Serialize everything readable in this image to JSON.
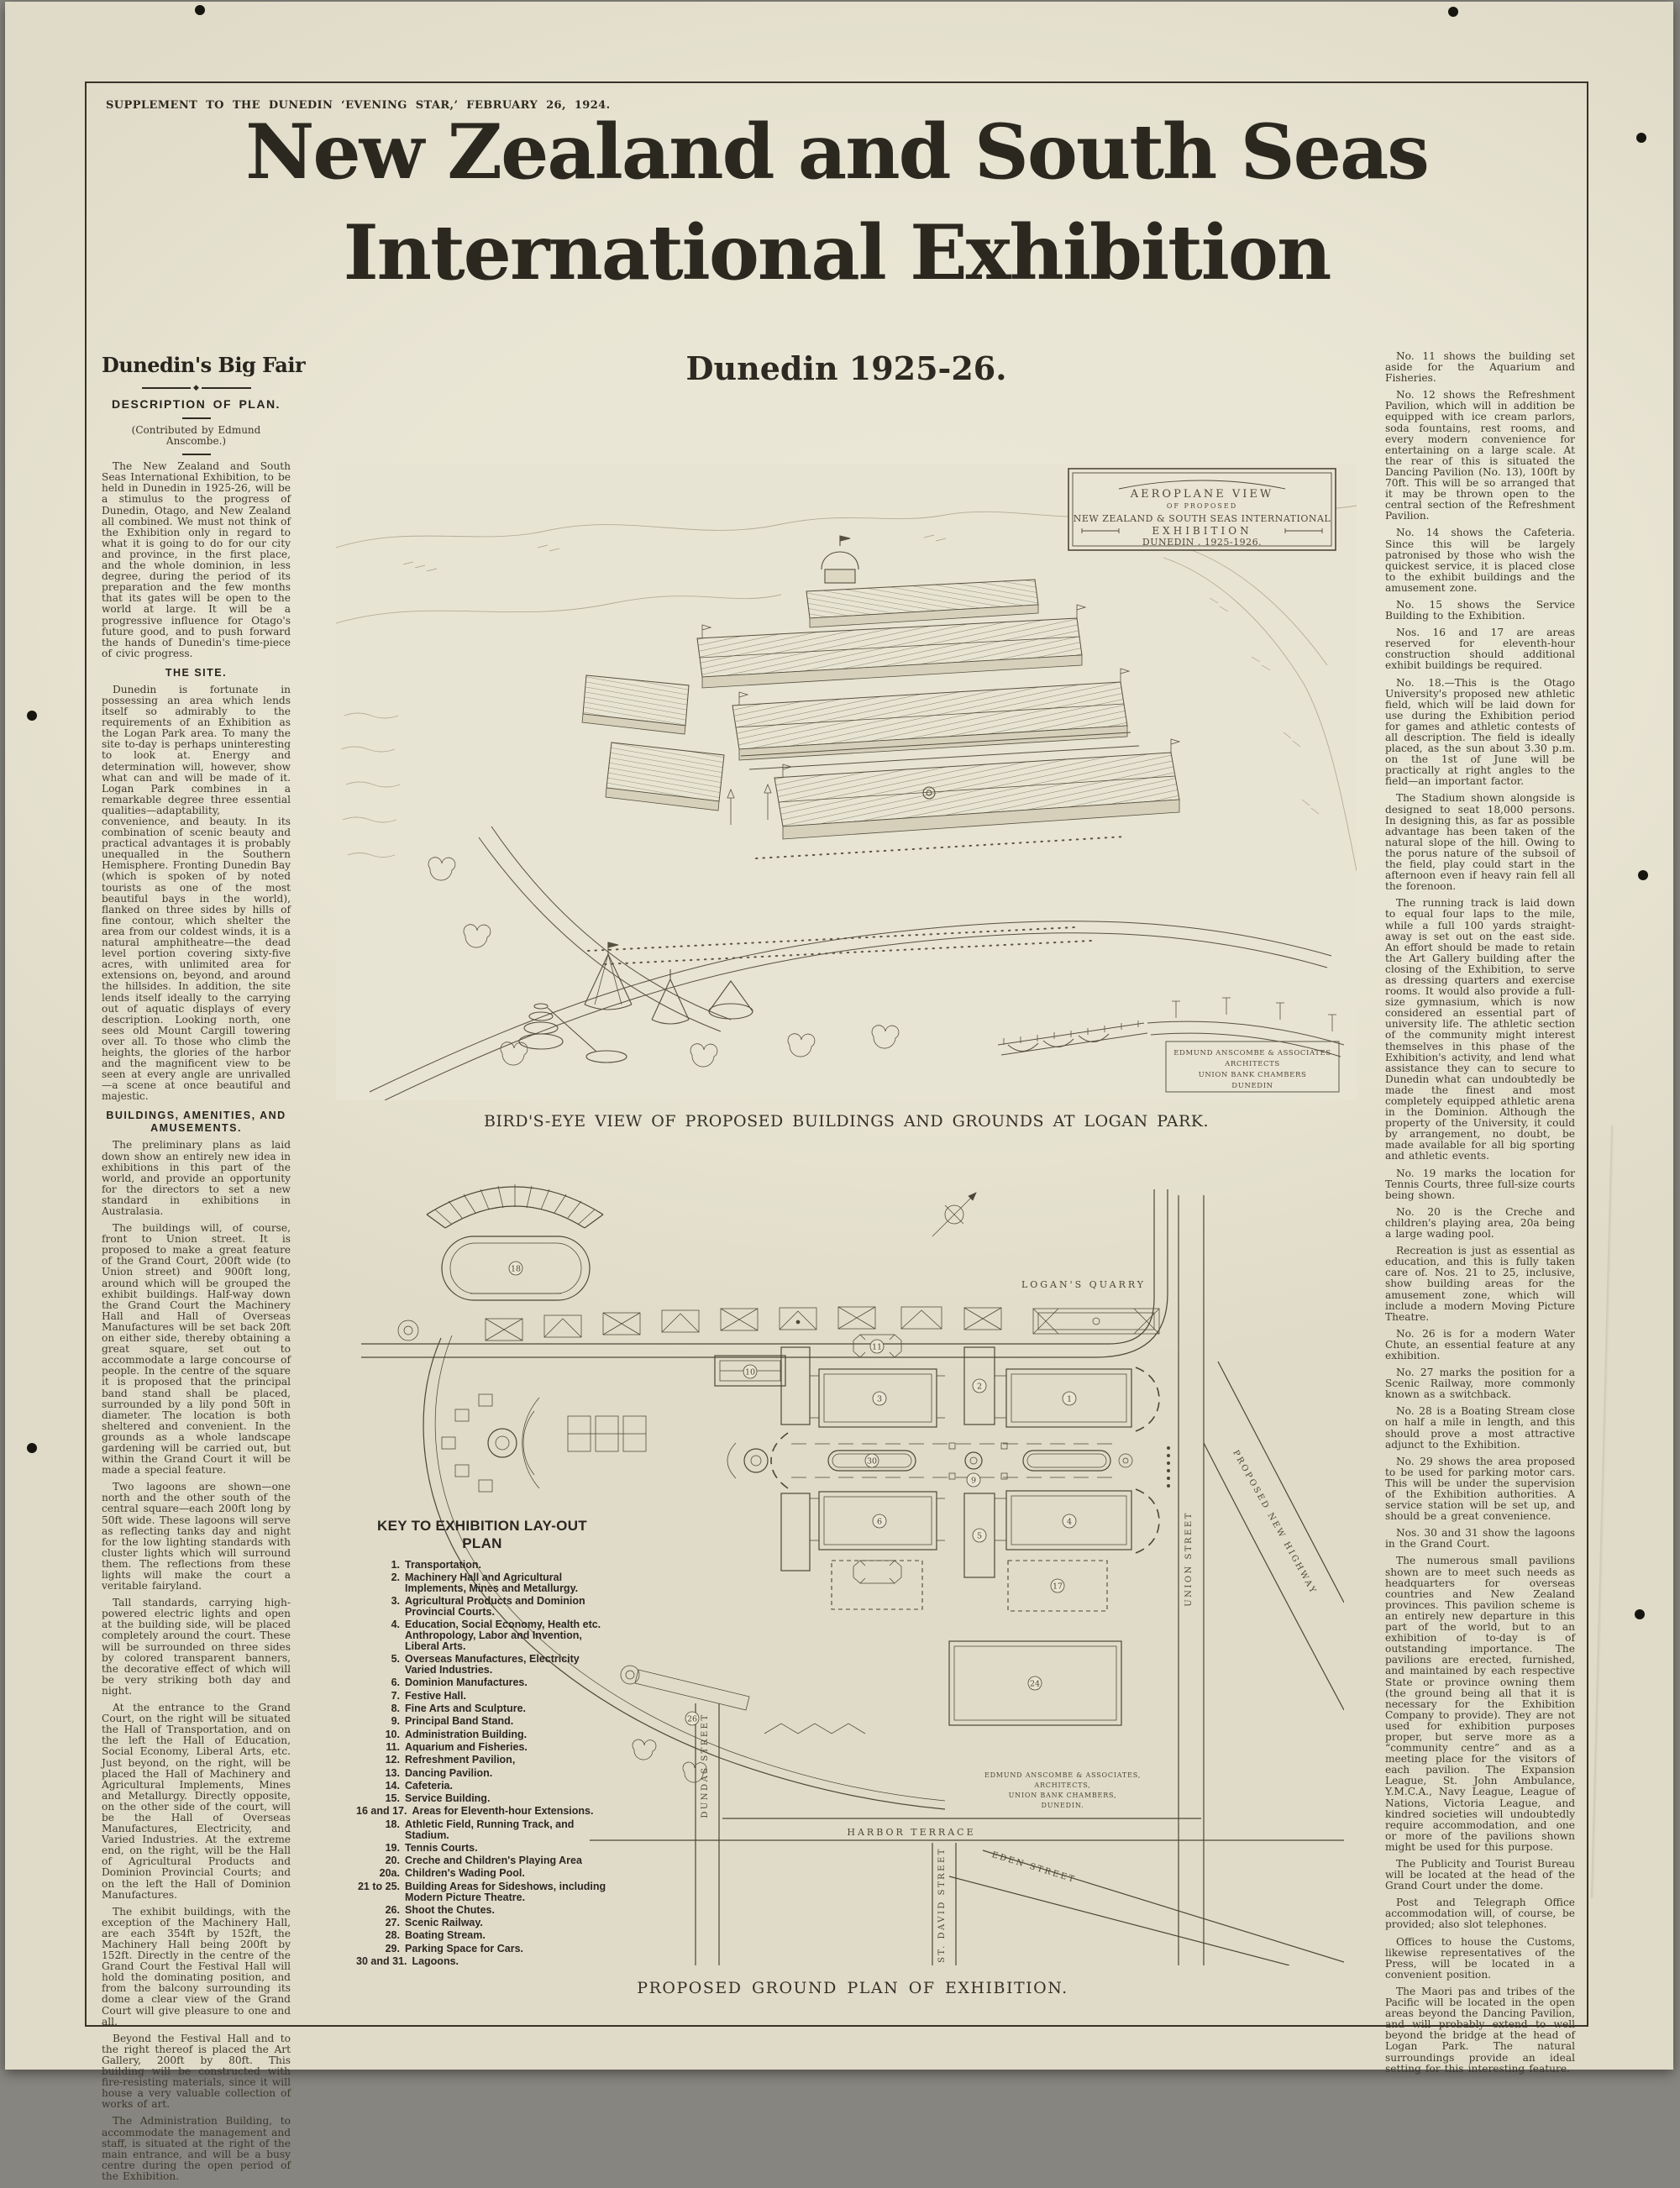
{
  "colors": {
    "paper": "#e9e5d4",
    "ink": "#2d2a22",
    "backdrop": "#87857f"
  },
  "masthead": {
    "supplement_line": "SUPPLEMENT TO THE DUNEDIN ‘EVENING STAR,’ FEBRUARY 26, 1924.",
    "title_line1": "New Zealand and South Seas",
    "title_line2": "International Exhibition",
    "subtitle": "Dunedin 1925-26."
  },
  "left_column": {
    "headline": "Dunedin's Big Fair",
    "subhead": "DESCRIPTION OF PLAN.",
    "byline": "(Contributed by Edmund Anscombe.)",
    "sections": {
      "intro": [
        "The New Zealand and South Seas International Exhibition, to be held in Dunedin in 1925-26, will be a stimulus to the progress of Dunedin, Otago, and New Zealand all combined. We must not think of the Exhibition only in regard to what it is going to do for our city and province, in the first place, and the whole dominion, in less degree, during the period of its preparation and the few months that its gates will be open to the world at large. It will be a progressive influence for Otago's future good, and to push forward the hands of Dunedin's time-piece of civic progress."
      ],
      "site_heading": "THE SITE.",
      "site": [
        "Dunedin is fortunate in possessing an area which lends itself so admirably to the requirements of an Exhibition as the Logan Park area. To many the site to-day is perhaps uninteresting to look at. Energy and determination will, however, show what can and will be made of it. Logan Park combines in a remarkable degree three essential qualities—adaptability, convenience, and beauty. In its combination of scenic beauty and practical advantages it is probably unequalled in the Southern Hemisphere. Fronting Dunedin Bay (which is spoken of by noted tourists as one of the most beautiful bays in the world), flanked on three sides by hills of fine contour, which shelter the area from our coldest winds, it is a natural amphitheatre—the dead level portion covering sixty-five acres, with unlimited area for extensions on, beyond, and around the hillsides. In addition, the site lends itself ideally to the carrying out of aquatic displays of every description. Looking north, one sees old Mount Cargill towering over all. To those who climb the heights, the glories of the harbor and the magnificent view to be seen at every angle are unrivalled—a scene at once beautiful and majestic."
      ],
      "amusements_heading": "BUILDINGS, AMENITIES, AND AMUSEMENTS.",
      "amusements": [
        "The preliminary plans as laid down show an entirely new idea in exhibitions in this part of the world, and provide an opportunity for the directors to set a new standard in exhibitions in Australasia.",
        "The buildings will, of course, front to Union street. It is proposed to make a great feature of the Grand Court, 200ft wide (to Union street) and 900ft long, around which will be grouped the exhibit buildings. Half-way down the Grand Court the Machinery Hall and Hall of Overseas Manufactures will be set back 20ft on either side, thereby obtaining a great square, set out to accommodate a large concourse of people. In the centre of the square it is proposed that the principal band stand shall be placed, surrounded by a lily pond 50ft in diameter. The location is both sheltered and convenient. In the grounds as a whole landscape gardening will be carried out, but within the Grand Court it will be made a special feature.",
        "Two lagoons are shown—one north and the other south of the central square—each 200ft long by 50ft wide. These lagoons will serve as reflecting tanks day and night for the low lighting standards with cluster lights which will surround them. The reflections from these lights will make the court a veritable fairyland.",
        "Tall standards, carrying high-powered electric lights and open at the building side, will be placed completely around the court. These will be surrounded on three sides by colored transparent banners, the decorative effect of which will be very striking both day and night.",
        "At the entrance to the Grand Court, on the right will be situated the Hall of Transportation, and on the left the Hall of Education, Social Economy, Liberal Arts, etc. Just beyond, on the right, will be placed the Hall of Machinery and Agricultural Implements, Mines and Metallurgy. Directly opposite, on the other side of the court, will be the Hall of Overseas Manufactures, Electricity, and Varied Industries. At the extreme end, on the right, will be the Hall of Agricultural Products and Dominion Provincial Courts; and on the left the Hall of Dominion Manufactures.",
        "The exhibit buildings, with the exception of the Machinery Hall, are each 354ft by 152ft, the Machinery Hall being 200ft by 152ft. Directly in the centre of the Grand Court the Festival Hall will hold the dominating position, and from the balcony surrounding its dome a clear view of the Grand Court will give pleasure to one and all.",
        "Beyond the Festival Hall and to the right thereof is placed the Art Gallery, 200ft by 80ft. This building will be constructed with fire-resisting materials, since it will house a very valuable collection of works of art.",
        "The Administration Building, to accommodate the management and staff, is situated at the right of the main entrance, and will be a busy centre during the open period of the Exhibition."
      ]
    }
  },
  "right_column": {
    "paragraphs": [
      "No. 11 shows the building set aside for the Aquarium and Fisheries.",
      "No. 12 shows the Refreshment Pavilion, which will in addition be equipped with ice cream parlors, soda fountains, rest rooms, and every modern convenience for entertaining on a large scale. At the rear of this is situated the Dancing Pavilion (No. 13), 100ft by 70ft. This will be so arranged that it may be thrown open to the central section of the Refreshment Pavilion.",
      "No. 14 shows the Cafeteria. Since this will be largely patronised by those who wish the quickest service, it is placed close to the exhibit buildings and the amusement zone.",
      "No. 15 shows the Service Building to the Exhibition.",
      "Nos. 16 and 17 are areas reserved for eleventh-hour construction should additional exhibit buildings be required.",
      "No. 18.—This is the Otago University's proposed new athletic field, which will be laid down for use during the Exhibition period for games and athletic contests of all description. The field is ideally placed, as the sun about 3.30 p.m. on the 1st of June will be practically at right angles to the field—an important factor.",
      "The Stadium shown alongside is designed to seat 18,000 persons. In designing this, as far as possible advantage has been taken of the natural slope of the hill. Owing to the porus nature of the subsoil of the field, play could start in the afternoon even if heavy rain fell all the forenoon.",
      "The running track is laid down to equal four laps to the mile, while a full 100 yards straight-away is set out on the east side. An effort should be made to retain the Art Gallery building after the closing of the Exhibition, to serve as dressing quarters and exercise rooms. It would also provide a full-size gymnasium, which is now considered an essential part of university life. The athletic section of the community might interest themselves in this phase of the Exhibition's activity, and lend what assistance they can to secure to Dunedin what can undoubtedly be made the finest and most completely equipped athletic arena in the Dominion. Although the property of the University, it could by arrangement, no doubt, be made available for all big sporting and athletic events.",
      "No. 19 marks the location for Tennis Courts, three full-size courts being shown.",
      "No. 20 is the Creche and children's playing area, 20a being a large wading pool.",
      "Recreation is just as essential as education, and this is fully taken care of. Nos. 21 to 25, inclusive, show building areas for the amusement zone, which will include a modern Moving Picture Theatre.",
      "No. 26 is for a modern Water Chute, an essential feature at any exhibition.",
      "No. 27 marks the position for a Scenic Railway, more commonly known as a switchback.",
      "No. 28 is a Boating Stream close on half a mile in length, and this should prove a most attractive adjunct to the Exhibition.",
      "No. 29 shows the area proposed to be used for parking motor cars. This will be under the supervision of the Exhibition authorities. A service station will be set up, and should be a great convenience.",
      "Nos. 30 and 31 show the lagoons in the Grand Court.",
      "The numerous small pavilions shown are to meet such needs as headquarters for overseas countries and New Zealand provinces. This pavilion scheme is an entirely new departure in this part of the world, but to an exhibition of to-day is of outstanding importance. The pavilions are erected, furnished, and maintained by each respective State or province owning them (the ground being all that it is necessary for the Exhibition Company to provide). They are not used for exhibition purposes proper, but serve more as a “community centre” and as a meeting place for the visitors of each pavilion. The Expansion League, St. John Ambulance, Y.M.C.A., Navy League, League of Nations, Victoria League, and kindred societies will undoubtedly require accommodation, and one or more of the pavilions shown might be used for this purpose.",
      "The Publicity and Tourist Bureau will be located at the head of the Grand Court under the dome.",
      "Post and Telegraph Office accommodation will, of course, be provided; also slot telephones.",
      "Offices to house the Customs, likewise representatives of the Press, will be located in a convenient position.",
      "The Maori pas and tribes of the Pacific will be located in the open areas beyond the Dancing Pavilion, and will probably extend to well beyond the bridge at the head of Logan Park. The natural surroundings provide an ideal setting for this interesting feature."
    ]
  },
  "birdseye": {
    "cartouche": [
      "AEROPLANE VIEW",
      "OF PROPOSED",
      "NEW ZEALAND & SOUTH SEAS INTERNATIONAL",
      "EXHIBITION",
      "DUNEDIN . 1925-1926."
    ],
    "credit": [
      "EDMUND ANSCOMBE & ASSOCIATES",
      "ARCHITECTS",
      "UNION BANK CHAMBERS",
      "DUNEDIN"
    ]
  },
  "figures": {
    "birdseye_caption": "BIRD'S-EYE VIEW OF PROPOSED BUILDINGS AND GROUNDS AT LOGAN PARK.",
    "plan_caption": "PROPOSED GROUND PLAN OF EXHIBITION."
  },
  "plan": {
    "labels": {
      "quarry": "LOGAN'S QUARRY",
      "union": "UNION STREET",
      "highway": "PROPOSED NEW HIGHWAY",
      "harbor": "HARBOR TERRACE",
      "dundas": "DUNDAS STREET",
      "stdavid": "ST. DAVID STREET",
      "eden": "EDEN STREET"
    },
    "credit": [
      "EDMUND ANSCOMBE & ASSOCIATES,",
      "ARCHITECTS,",
      "UNION BANK CHAMBERS,",
      "DUNEDIN."
    ],
    "numbers": [
      "1",
      "2",
      "3",
      "4",
      "5",
      "6",
      "9",
      "10",
      "11",
      "17",
      "18",
      "24",
      "26",
      "30"
    ]
  },
  "key": {
    "heading_line1": "KEY TO EXHIBITION LAY-OUT",
    "heading_line2": "PLAN",
    "items": [
      {
        "n": "1.",
        "t": "Transportation."
      },
      {
        "n": "2.",
        "t": "Machinery Hall and Agricultural Implements, Mines and Metallurgy."
      },
      {
        "n": "3.",
        "t": "Agricultural Products and Dominion Provincial Courts."
      },
      {
        "n": "4.",
        "t": "Education, Social Economy, Health etc. Anthropology, Labor and Invention, Liberal Arts."
      },
      {
        "n": "5.",
        "t": "Overseas Manufactures, Electricity Varied Industries."
      },
      {
        "n": "6.",
        "t": "Dominion Manufactures."
      },
      {
        "n": "7.",
        "t": "Festive Hall."
      },
      {
        "n": "8.",
        "t": "Fine Arts and Sculpture."
      },
      {
        "n": "9.",
        "t": "Principal Band Stand."
      },
      {
        "n": "10.",
        "t": "Administration Building."
      },
      {
        "n": "11.",
        "t": "Aquarium and Fisheries."
      },
      {
        "n": "12.",
        "t": "Refreshment Pavilion,"
      },
      {
        "n": "13.",
        "t": "Dancing Pavilion."
      },
      {
        "n": "14.",
        "t": "Cafeteria."
      },
      {
        "n": "15.",
        "t": "Service Building."
      },
      {
        "n": "16 and 17.",
        "t": "Areas for Eleventh-hour Extensions."
      },
      {
        "n": "18.",
        "t": "Athletic Field, Running Track, and Stadium."
      },
      {
        "n": "19.",
        "t": "Tennis Courts."
      },
      {
        "n": "20.",
        "t": "Creche and Children's Playing Area"
      },
      {
        "n": "20a.",
        "t": "Children's Wading Pool."
      },
      {
        "n": "21 to 25.",
        "t": "Building Areas for Sideshows, including Modern Picture Theatre."
      },
      {
        "n": "26.",
        "t": "Shoot the Chutes."
      },
      {
        "n": "27.",
        "t": "Scenic Railway."
      },
      {
        "n": "28.",
        "t": "Boating Stream."
      },
      {
        "n": "29.",
        "t": "Parking Space for Cars."
      },
      {
        "n": "30 and 31.",
        "t": "Lagoons."
      }
    ]
  }
}
